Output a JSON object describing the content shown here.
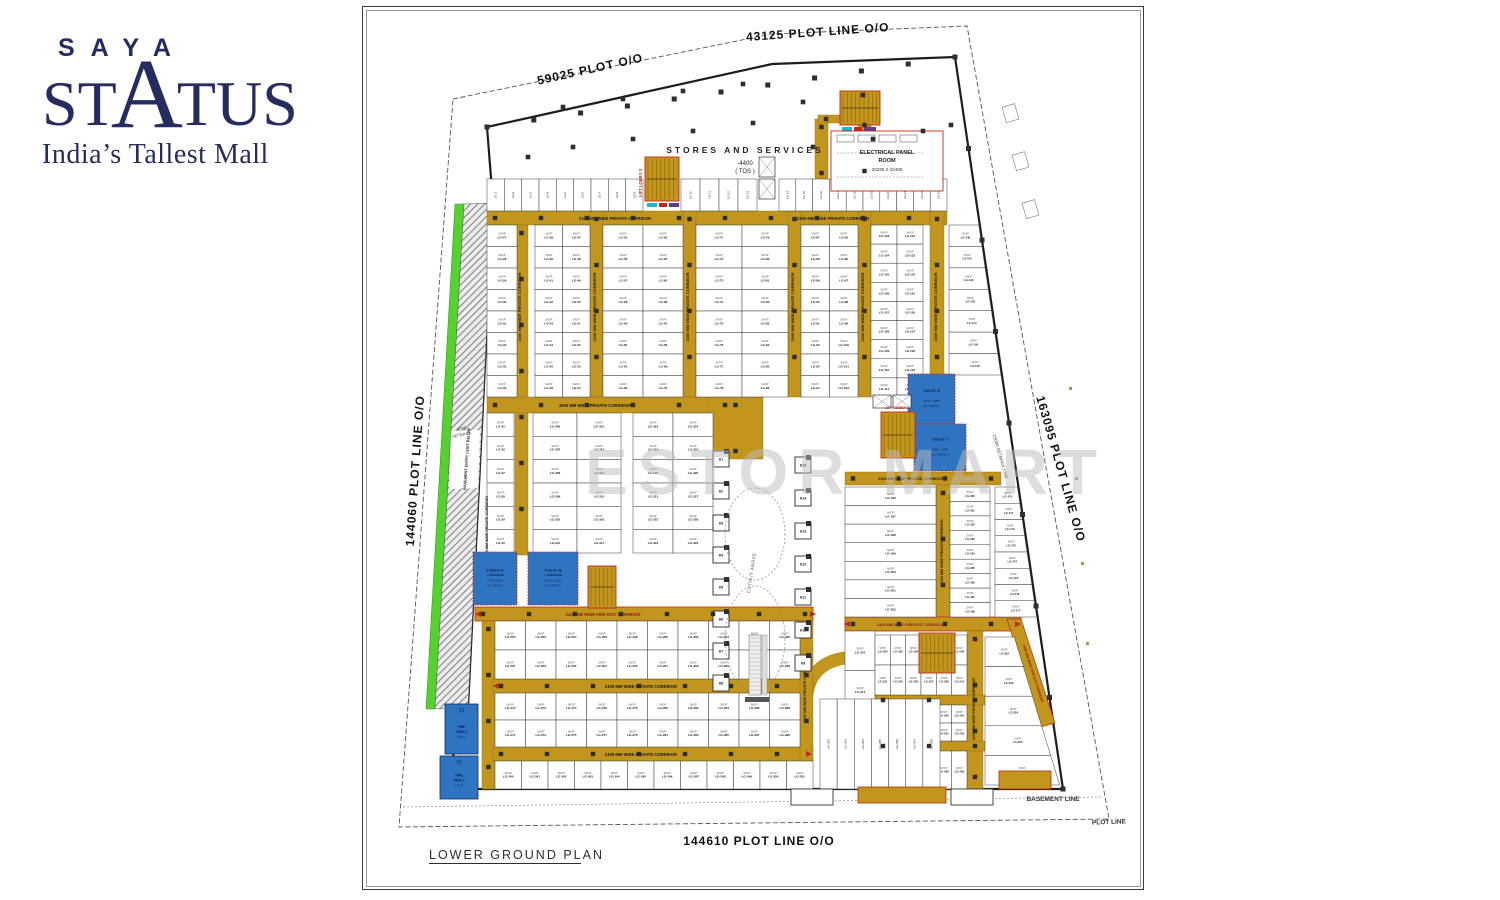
{
  "logo": {
    "saya": "SAYA",
    "status_left": "ST",
    "status_a": "A",
    "status_right": "TUS",
    "tagline": "India’s Tallest Mall",
    "color": "#252c60"
  },
  "watermark": "ESTOR MART",
  "plan": {
    "title": "LOWER GROUND PLAN",
    "shop_word": "SHOP",
    "unit_prefix": "LG-",
    "corridor_labels": {
      "p2100": "2100 MM WIDE PRIVATE CORRIDOR",
      "p3000": "3000 MM WIDE PRIVATE CORRIDOR",
      "f2400": "2400 MM WIDE FIRE EXIT CORRIDOR"
    },
    "kiosks_left": [
      "K1",
      "K2",
      "K3",
      "K4",
      "K5",
      "K6",
      "K7",
      "K8"
    ],
    "kiosks_right": [
      "K15",
      "K14",
      "K13",
      "K12",
      "K11",
      "K10",
      "K9"
    ],
    "toilets": [
      {
        "name": "TOILET D",
        "dims": "8170 x 7985",
        "note": "( A1 / DETAIL )"
      },
      {
        "name": "TOILET C",
        "dims": "9905 x 7985",
        "note": "( A1 / DETAIL 2 )"
      },
      {
        "name": "TOILET A",
        "sub": "+ SERVICES",
        "dims": "7730 x 8150",
        "note": "( A1 / DETAIL )"
      },
      {
        "name": "TOILET B",
        "sub": "+ SERVICES",
        "dims": "10675 x 8150",
        "note": "( A1 / DETAIL )"
      }
    ],
    "tanks": [
      {
        "name": "FIRE TANK 2",
        "cap": "375 KL"
      },
      {
        "name": "FIRE TANK 1",
        "cap": "275 KL"
      }
    ],
    "text_labels": [
      [
        "59025 PLOT O/O",
        228,
        66,
        -12.5,
        12,
        "#111",
        "bold",
        1
      ],
      [
        "43125 PLOT LINE O/O",
        455,
        29,
        -4,
        12,
        "#111",
        "bold",
        1
      ],
      [
        "144060 PLOT LINE O/O",
        56,
        464,
        -86,
        12,
        "#111",
        "bold",
        1
      ],
      [
        "163095 PLOT LINE O/O",
        694,
        463,
        74,
        12,
        "#111",
        "bold",
        1
      ],
      [
        "144610 PLOT LINE O/O",
        396,
        838,
        0,
        12,
        "#111",
        "bold",
        1
      ],
      [
        "BASEMENT LINE",
        690,
        794,
        0,
        6.5,
        "#333",
        "bold",
        0
      ],
      [
        "PLOT LINE",
        746,
        817,
        -2,
        6.5,
        "#333",
        "bold",
        0
      ],
      [
        "15000 SETBACK LINE",
        636,
        450,
        74,
        4.5,
        "#444",
        "normal",
        0
      ],
      [
        "9000",
        99,
        423,
        -12,
        4.2,
        "#444",
        "normal",
        0
      ],
      [
        "SETBACK",
        99,
        429,
        -12,
        4.2,
        "#444",
        "normal",
        0
      ],
      [
        "BASEMENT ENTRY / EXIT BELOW",
        105,
        452,
        -86,
        3.8,
        "#222",
        "bold",
        0
      ],
      [
        "STORES AND SERVICES",
        382,
        146,
        0,
        8.5,
        "#222",
        "bold",
        3
      ],
      [
        "-4400",
        382,
        158,
        0,
        6,
        "#222",
        "normal",
        0
      ],
      [
        "( TOS )",
        382,
        166,
        0,
        6,
        "#222",
        "normal",
        0
      ],
      [
        "LIFT LOBBY 3",
        279,
        176,
        -90,
        4.2,
        "#c0281a",
        "bold",
        0
      ],
      [
        "LIFT LOBBY 2",
        534,
        402,
        0,
        3.6,
        "#c0281a",
        "bold",
        0
      ],
      [
        "CUTOUT ABOVE",
        390,
        566,
        -82,
        4.5,
        "#555",
        "normal",
        0.5
      ],
      [
        "ELECTRICAL PANEL",
        524,
        147,
        0,
        5.5,
        "#222",
        "bold",
        0
      ],
      [
        "ROOM",
        524,
        155,
        0,
        5.5,
        "#222",
        "bold",
        0
      ],
      [
        "26330 X 22485",
        524,
        164,
        0,
        4.5,
        "#333",
        "normal",
        0
      ]
    ]
  },
  "layout": {
    "colors": {
      "corridor": "#c2951d",
      "corridor_edge": "#8a6a10",
      "fire_edge": "#c0281a",
      "blue": "#2e74c0",
      "blue_edge": "#1b4c8c",
      "navy_text": "#0a1d4d",
      "green": "#55d22e",
      "green_edge": "#2f8a12",
      "wall": "#1d1d1d",
      "red": "#c0281a"
    },
    "plot_pts": "90,92 408,27 604,19 746,812 36,820",
    "basement_pts": "40,800 740,790",
    "building_pts": "124,120 409,57 592,50 700,782 80,782 105,700 130,196",
    "green_pts": "92,197 101,197 72,702 63,702",
    "ramp_pts": "101,197 130,196 105,700 72,702",
    "ramp_gap": "88,424 117,423 115,481 86,482",
    "corridor_arc": "M 443,698 Q 443,652 492,650",
    "corridor_rects": [
      [
        124,
        204,
        460,
        14
      ],
      [
        152,
        218,
        13,
        330
      ],
      [
        227,
        204,
        13,
        186
      ],
      [
        320,
        204,
        13,
        186
      ],
      [
        425,
        204,
        13,
        186
      ],
      [
        495,
        204,
        13,
        186
      ],
      [
        495,
        110,
        13,
        94
      ],
      [
        567,
        204,
        14,
        186
      ],
      [
        124,
        390,
        262,
        16
      ],
      [
        345,
        390,
        55,
        62
      ],
      [
        482,
        465,
        156,
        13
      ],
      [
        573,
        478,
        14,
        134
      ],
      [
        482,
        610,
        176,
        14,
        1
      ],
      [
        604,
        624,
        16,
        158
      ],
      [
        512,
        688,
        126,
        10
      ],
      [
        512,
        734,
        126,
        10
      ],
      [
        112,
        600,
        338,
        14,
        1
      ],
      [
        119,
        614,
        13,
        168
      ],
      [
        130,
        672,
        320,
        14
      ],
      [
        130,
        740,
        320,
        14
      ],
      [
        437,
        614,
        13,
        140
      ],
      [
        452,
        112,
        13,
        92
      ],
      [
        455,
        108,
        25,
        8
      ]
    ],
    "corridor_polys": [
      [
        644,
        612,
        658,
        612,
        692,
        716,
        678,
        720
      ]
    ],
    "corridor_texts": [
      [
        "p2100",
        252,
        213,
        0,
        4.2
      ],
      [
        "p2100",
        470,
        213,
        0,
        4.2
      ],
      [
        "p2100",
        158,
        300,
        -90,
        4
      ],
      [
        "p2100",
        233,
        300,
        -90,
        4
      ],
      [
        "p2100",
        326,
        300,
        -90,
        4
      ],
      [
        "p2100",
        431,
        300,
        -90,
        4
      ],
      [
        "p2100",
        501,
        300,
        -90,
        4
      ],
      [
        "p2100",
        574,
        300,
        -90,
        4
      ],
      [
        "p3000",
        232,
        400,
        0,
        4.2
      ],
      [
        "p2100",
        548,
        473,
        0,
        3.8
      ],
      [
        "p2100",
        580,
        545,
        -90,
        3.8
      ],
      [
        "f2400",
        548,
        619,
        0,
        3.8,
        1
      ],
      [
        "p2100",
        612,
        702,
        -90,
        3.6
      ],
      [
        "f2400",
        240,
        609,
        0,
        4.2,
        1
      ],
      [
        "p2100",
        278,
        681,
        0,
        4.2
      ],
      [
        "p2100",
        278,
        749,
        0,
        4.2
      ],
      [
        "f2400",
        669,
        667,
        72,
        3.4,
        1
      ],
      [
        "p2100",
        443,
        684,
        -90,
        3.6
      ],
      [
        "p2100",
        125,
        520,
        -90,
        3.6
      ]
    ],
    "shop_blocks": [
      [
        124,
        218,
        30,
        172,
        8,
        1,
        27
      ],
      [
        172,
        218,
        55,
        172,
        8,
        2,
        39
      ],
      [
        240,
        218,
        80,
        172,
        8,
        2,
        55
      ],
      [
        333,
        218,
        92,
        172,
        8,
        2,
        71
      ],
      [
        438,
        218,
        57,
        172,
        8,
        2,
        87
      ],
      [
        508,
        218,
        52,
        172,
        9,
        2,
        103
      ],
      [
        124,
        406,
        27,
        140,
        6,
        1,
        35
      ],
      [
        170,
        406,
        88,
        140,
        6,
        2,
        306
      ],
      [
        270,
        406,
        80,
        140,
        6,
        2,
        318
      ],
      [
        482,
        480,
        91,
        130,
        7,
        1,
        196
      ],
      [
        587,
        480,
        40,
        130,
        9,
        1,
        180
      ],
      [
        132,
        614,
        305,
        58,
        2,
        10,
        250
      ],
      [
        132,
        686,
        305,
        54,
        2,
        10,
        270
      ],
      [
        132,
        754,
        318,
        28,
        1,
        12,
        340
      ],
      [
        482,
        624,
        30,
        158,
        4,
        1,
        216
      ],
      [
        512,
        628,
        92,
        60,
        2,
        6,
        230
      ],
      [
        512,
        698,
        92,
        36,
        2,
        6,
        242
      ],
      [
        512,
        744,
        92,
        38,
        1,
        6,
        254
      ]
    ],
    "slant_blocks": [
      {
        "x": 586,
        "y": 218,
        "h": 150,
        "r": 7,
        "s": 140,
        "rl": [
          592,
          50,
          700,
          782
        ]
      },
      {
        "x": 632,
        "y": 480,
        "h": 130,
        "r": 8,
        "s": 170,
        "rl": [
          592,
          50,
          700,
          782
        ]
      },
      {
        "x": 622,
        "y": 630,
        "h": 148,
        "r": 5,
        "s": 222,
        "rl": [
          648,
          616,
          694,
          766
        ]
      }
    ],
    "stall_runs": [
      [
        124,
        172,
        156,
        32,
        9,
        1
      ],
      [
        318,
        172,
        76,
        32,
        4,
        10
      ],
      [
        416,
        172,
        168,
        32,
        10,
        14
      ],
      [
        457,
        692,
        120,
        90,
        7,
        352
      ]
    ],
    "toilets_geo": [
      [
        545,
        367,
        47,
        50
      ],
      [
        551,
        417,
        52,
        47
      ],
      [
        110,
        545,
        44,
        53
      ],
      [
        165,
        545,
        50,
        53
      ]
    ],
    "tanks_geo": [
      [
        82,
        697,
        33,
        50
      ],
      [
        77,
        749,
        38,
        43
      ]
    ],
    "stairs": [
      [
        282,
        150,
        34,
        44
      ],
      [
        477,
        84,
        40,
        34
      ],
      [
        518,
        405,
        34,
        46
      ],
      [
        556,
        626,
        36,
        40
      ],
      [
        225,
        559,
        28,
        42
      ]
    ],
    "strips": [
      [
        284,
        196,
        10,
        4,
        "#18b8c8"
      ],
      [
        296,
        196,
        8,
        4,
        "#c0281a"
      ],
      [
        306,
        196,
        10,
        4,
        "#5a3b8c"
      ],
      [
        479,
        120,
        10,
        4,
        "#18b8c8"
      ],
      [
        491,
        120,
        8,
        4,
        "#c0281a"
      ],
      [
        501,
        120,
        12,
        4,
        "#5a3b8c"
      ]
    ],
    "lifts": [
      [
        396,
        150,
        16,
        20
      ],
      [
        396,
        172,
        16,
        20
      ],
      [
        510,
        388,
        18,
        13
      ],
      [
        530,
        388,
        18,
        13
      ]
    ],
    "electrical": {
      "rect": [
        468,
        124,
        112,
        60
      ],
      "panels": [
        [
          474,
          128,
          17,
          7
        ],
        [
          495,
          128,
          17,
          7
        ],
        [
          516,
          128,
          17,
          7
        ],
        [
          537,
          128,
          17,
          7
        ]
      ],
      "dash": [
        [
          474,
          146,
          560,
          146
        ],
        [
          474,
          170,
          560,
          170
        ]
      ]
    },
    "kiosks": {
      "lx": 350,
      "rx": 432,
      "size": 16,
      "lys": [
        444,
        476,
        508,
        540,
        572,
        604,
        636,
        668
      ],
      "rys": [
        450,
        483,
        516,
        549,
        582,
        615,
        648
      ]
    },
    "escalator": {
      "ell": [
        [
          392,
          527,
          30,
          46
        ],
        [
          392,
          632,
          30,
          53
        ]
      ],
      "unit": [
        386,
        628,
        12,
        60
      ],
      "side": [
        399,
        628,
        5,
        60
      ],
      "base": [
        382,
        690,
        24,
        5
      ]
    },
    "smallboxes": [
      [
        640,
        100
      ],
      [
        650,
        148
      ],
      [
        660,
        196
      ]
    ],
    "green_dots": [
      [
        706,
        380
      ],
      [
        712,
        470
      ],
      [
        718,
        555
      ],
      [
        723,
        635
      ]
    ],
    "protrusions": [
      [
        428,
        782,
        42,
        16
      ],
      [
        588,
        782,
        42,
        16
      ]
    ],
    "entries": [
      [
        495,
        780,
        88,
        16
      ],
      [
        636,
        764,
        52,
        18
      ]
    ],
    "arrows": [
      [
        118,
        607,
        -1
      ],
      [
        447,
        607,
        1
      ],
      [
        487,
        617,
        -1
      ],
      [
        652,
        617,
        1
      ],
      [
        443,
        747,
        1
      ],
      [
        136,
        679,
        -1
      ]
    ],
    "columns_scatter": [
      [
        200,
        100
      ],
      [
        260,
        92
      ],
      [
        320,
        84
      ],
      [
        380,
        77
      ],
      [
        440,
        95
      ],
      [
        500,
        88
      ],
      [
        210,
        140
      ],
      [
        270,
        132
      ],
      [
        330,
        124
      ],
      [
        390,
        116
      ],
      [
        450,
        140
      ],
      [
        510,
        132
      ],
      [
        560,
        124
      ],
      [
        165,
        150
      ],
      [
        588,
        118
      ]
    ]
  }
}
